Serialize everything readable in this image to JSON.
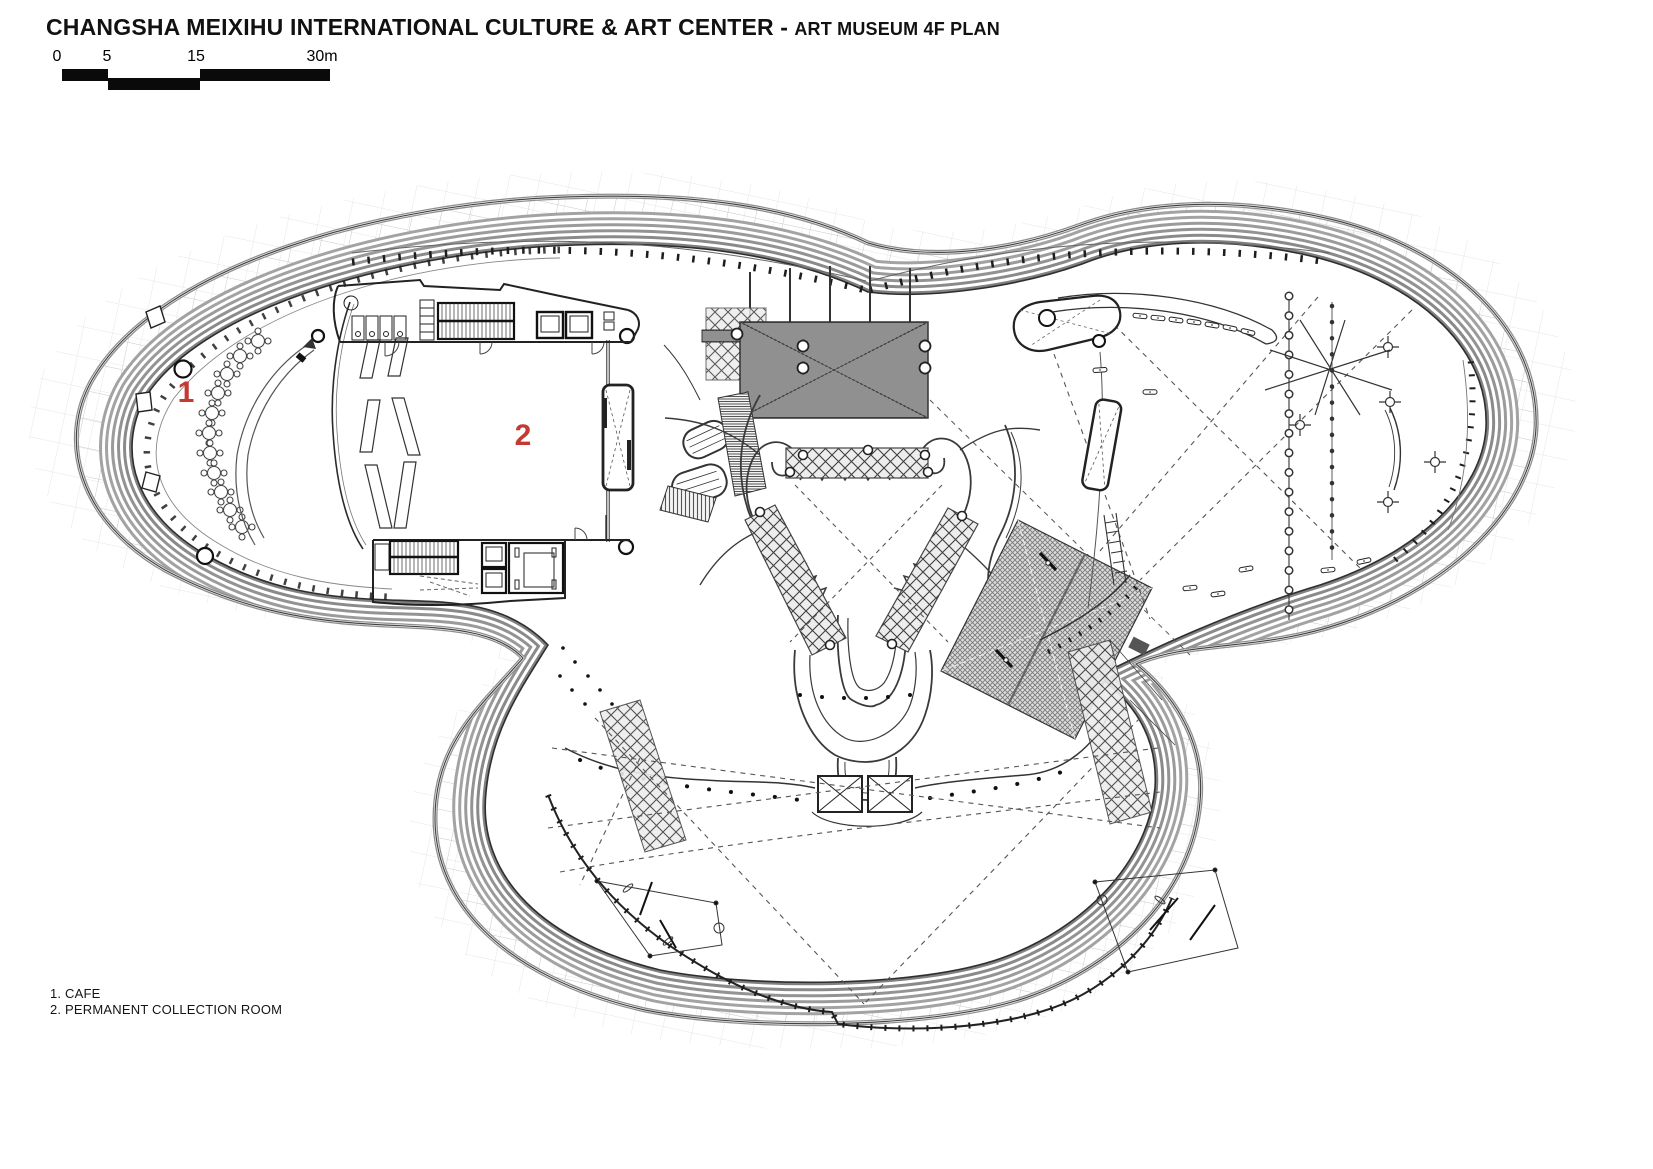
{
  "header": {
    "title_main": "CHANGSHA MEIXIHU INTERNATIONAL CULTURE & ART CENTER",
    "title_dash": " - ",
    "title_sub": "ART MUSEUM 4F PLAN"
  },
  "scale_bar": {
    "labels": [
      "0",
      "5",
      "15",
      "30m"
    ]
  },
  "legend": {
    "items": [
      {
        "label": "1. CAFE"
      },
      {
        "label": "2. PERMANENT COLLECTION ROOM"
      }
    ]
  },
  "plan": {
    "markers": [
      {
        "label": "1",
        "room": "cafe"
      },
      {
        "label": "2",
        "room": "permanent collection room"
      }
    ],
    "marker_color": "#c43a31"
  },
  "colors": {
    "ink": "#2e2e2e",
    "contour_gray": "#a3a3a3",
    "mesh_gray": "#c8c8c8",
    "accent_red": "#c43a31"
  }
}
